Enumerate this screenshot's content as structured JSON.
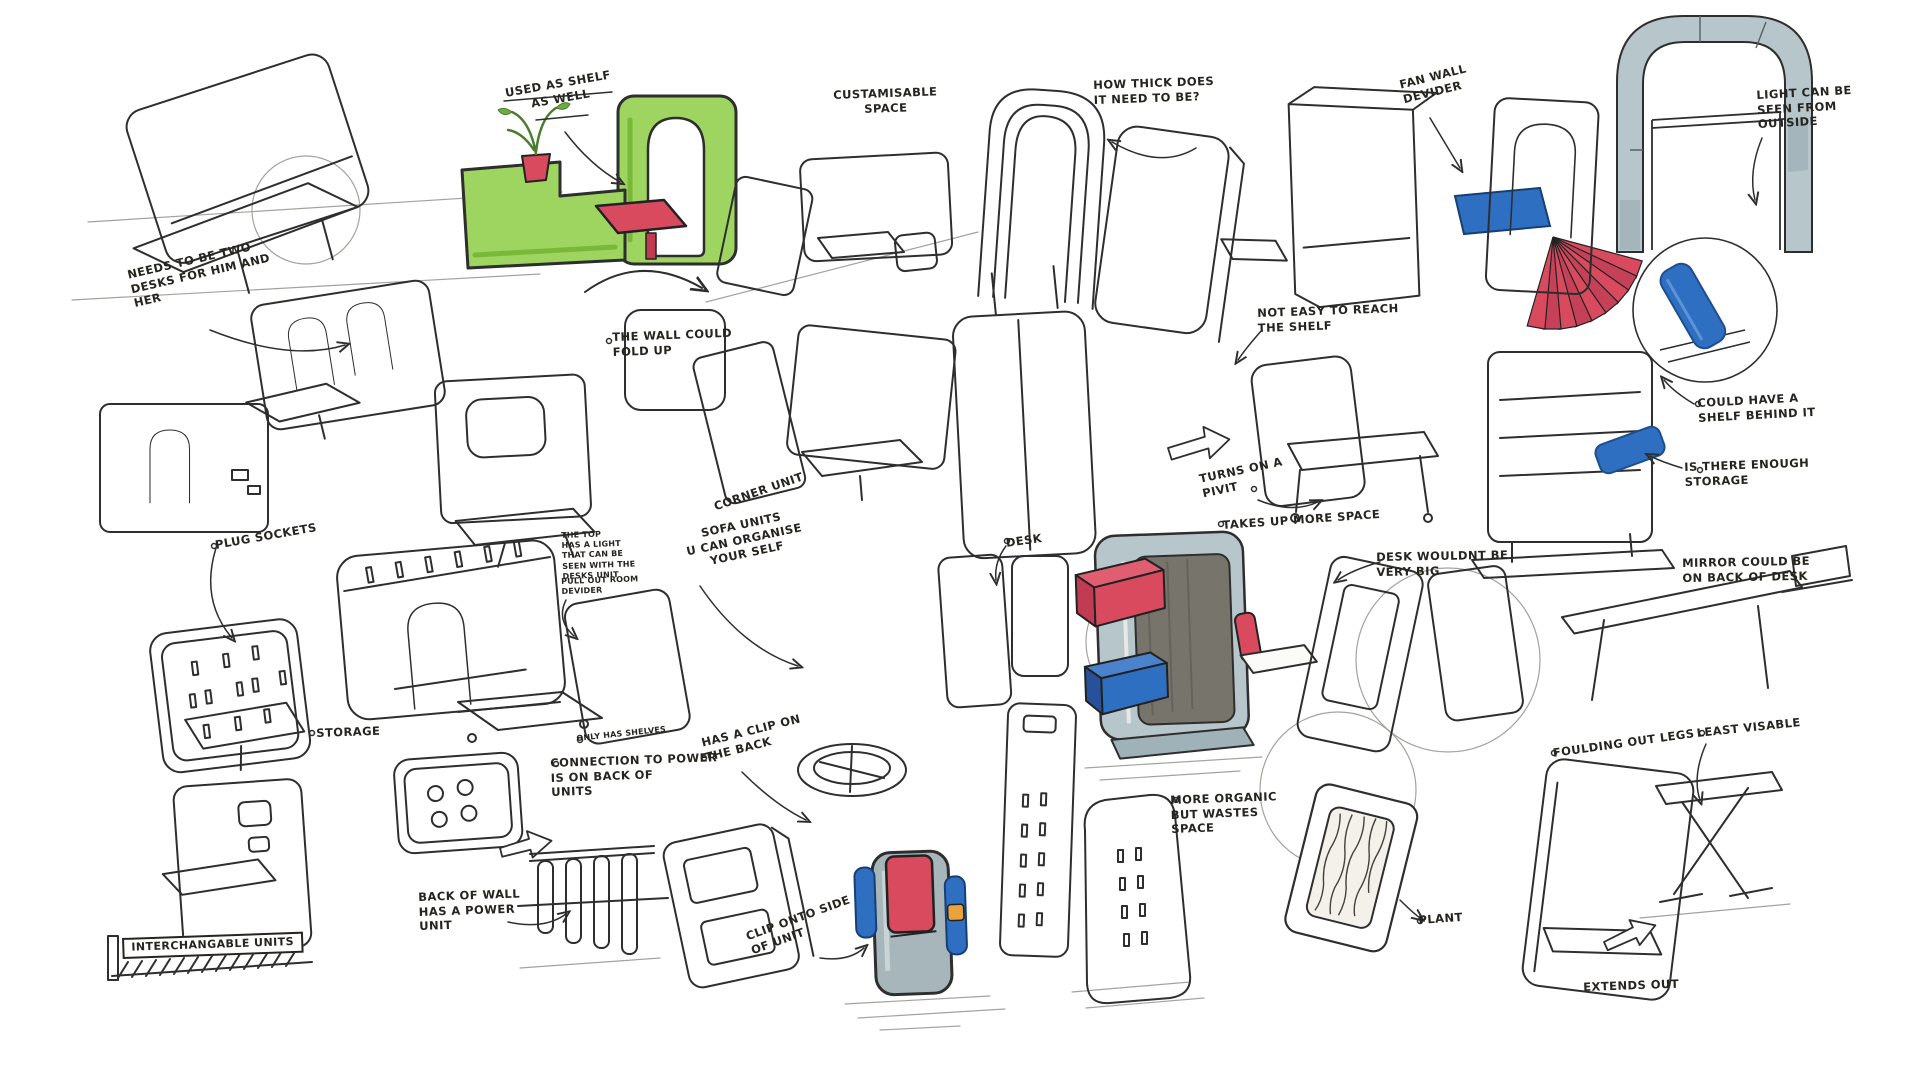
{
  "sheet": {
    "kind": "furniture-concept-sketch-page"
  },
  "palette": {
    "paper": "#ffffff",
    "ink": "#2e2e2e",
    "pencil": "#a3a39e",
    "marker_green": "#9ed460",
    "marker_green_dark": "#7ab83a",
    "marker_red": "#d94a5f",
    "marker_blue": "#2f6fc1",
    "marker_grey": "#b7c6ca",
    "marker_orange": "#e8a33d",
    "interior_grey": "#77746c",
    "plant_green": "#4c7d2f"
  },
  "annotations": {
    "used_as_shelf": "USED AS SHELF\nAS WELL",
    "customisable_space": "CUSTAMISABLE\nSPACE",
    "how_thick": "HOW THICK DOES\nIT NEED TO BE?",
    "fan_wall_divider": "FAN WALL\nDEVIDER",
    "light_seen_outside": "LIGHT CAN BE\nSEEN FROM\nOUTSIDE",
    "two_desks": "NEEDS TO BE TWO\nDESKS FOR HIM AND\nHER",
    "wall_fold_up": "THE WALL COULD\nFOLD UP",
    "not_easy_reach": "NOT EASY TO REACH\nTHE SHELF",
    "shelf_behind": "COULD HAVE A\nSHELF BEHIND IT",
    "enough_storage": "IS THERE ENOUGH\nSTORAGE",
    "corner_unit": "CORNER UNIT",
    "sofa_units": "SOFA UNITS\nU CAN ORGANISE\nYOUR SELF",
    "turns_pivot": "TURNS ON A\nPIVIT",
    "takes_space": "TAKES UP MORE SPACE",
    "desk": "DESK",
    "desk_not_big": "DESK WOULDNT BE\nVERY BIG",
    "mirror_back": "MIRROR COULD BE\nON BACK OF DESK",
    "plug_sockets": "PLUG SOCKETS",
    "top_light": "THE TOP\nHAS A LIGHT\nTHAT CAN BE\nSEEN WITH THE\nDESKS UNIT",
    "pull_out_divider": "PULL OUT ROOM\nDEVIDER",
    "storage": "STORAGE",
    "only_shelves": "ONLY HAS SHELVES",
    "connection_power": "CONNECTION TO POWER\nIS ON BACK OF\nUNITS",
    "clip_back": "HAS A CLIP ON\nTHE BACK",
    "back_wall_power": "BACK OF WALL\nHAS A POWER\nUNIT",
    "interchangable": "INTERCHANGABLE UNITS",
    "clip_onto_side": "CLIP ONTO SIDE\nOF UNIT",
    "more_organic": "MORE ORGANIC\nBUT WASTES\nSPACE",
    "plant": "PLANT",
    "folding_legs": "FOULDING OUT LEGS",
    "least_visable": "LEAST VISABLE",
    "extends_out": "EXTENDS OUT"
  }
}
